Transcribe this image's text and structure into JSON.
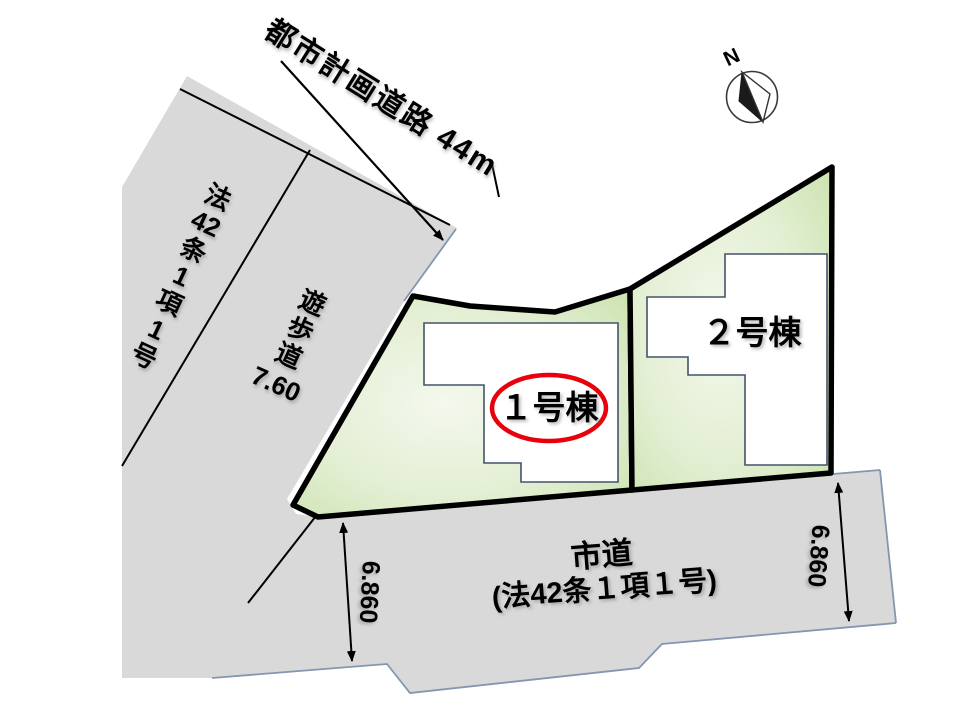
{
  "compass": {
    "north_label": "N"
  },
  "planning_road": {
    "label": "都市計画道路 44m"
  },
  "law_road": {
    "chars": [
      "法",
      "42",
      "条",
      "1",
      "項",
      "1",
      "号"
    ]
  },
  "walkway": {
    "chars": [
      "遊",
      "歩",
      "道"
    ],
    "width_label": "7.60"
  },
  "city_road": {
    "name": "市道",
    "law": "(法42条１項１号)"
  },
  "lots": [
    {
      "label": "１号棟",
      "highlighted": true
    },
    {
      "label": "２号棟",
      "highlighted": false
    }
  ],
  "dimensions": {
    "left": "6.860",
    "right": "6.860"
  },
  "colors": {
    "road_gray": "#d9d9d9",
    "lot_green_center": "#f4f8ee",
    "lot_green_mid": "#e3efd3",
    "lot_green_edge": "#cbe2ae",
    "lot_border": "#000000",
    "building_outline": "#44546a",
    "building_fill": "#ffffff",
    "highlight_red": "#e8000d",
    "boundary_blue": "#8496b0",
    "line_black": "#000000"
  }
}
